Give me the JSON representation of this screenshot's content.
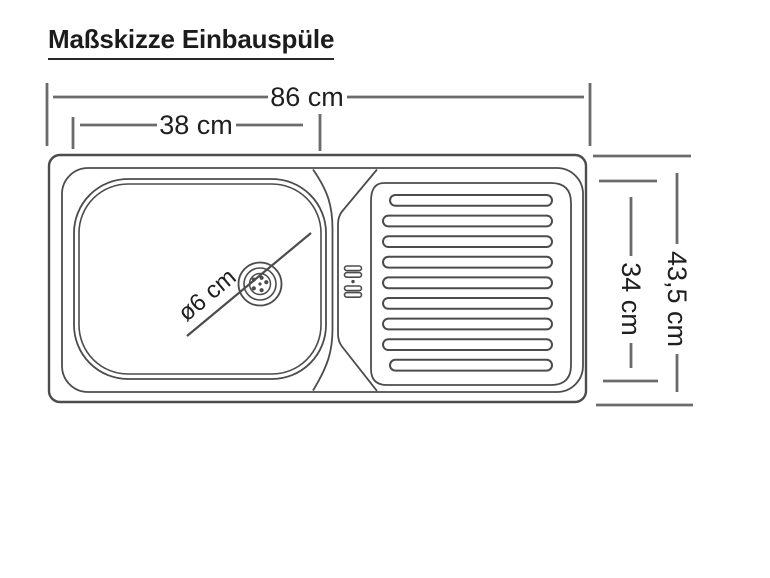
{
  "title": "Maßskizze Einbauspüle",
  "dimensions": {
    "overall_width_label": "86 cm",
    "basin_width_label": "38 cm",
    "overall_depth_label": "43,5 cm",
    "inner_depth_label": "34 cm",
    "drain_diameter_label": "ø6 cm"
  },
  "sink": {
    "groove_count": 9
  },
  "colors": {
    "background": "#ffffff",
    "drawing_stroke": "#4c4c4c",
    "dimension_stroke": "#6b6b6b",
    "text": "#1f1f1f"
  }
}
